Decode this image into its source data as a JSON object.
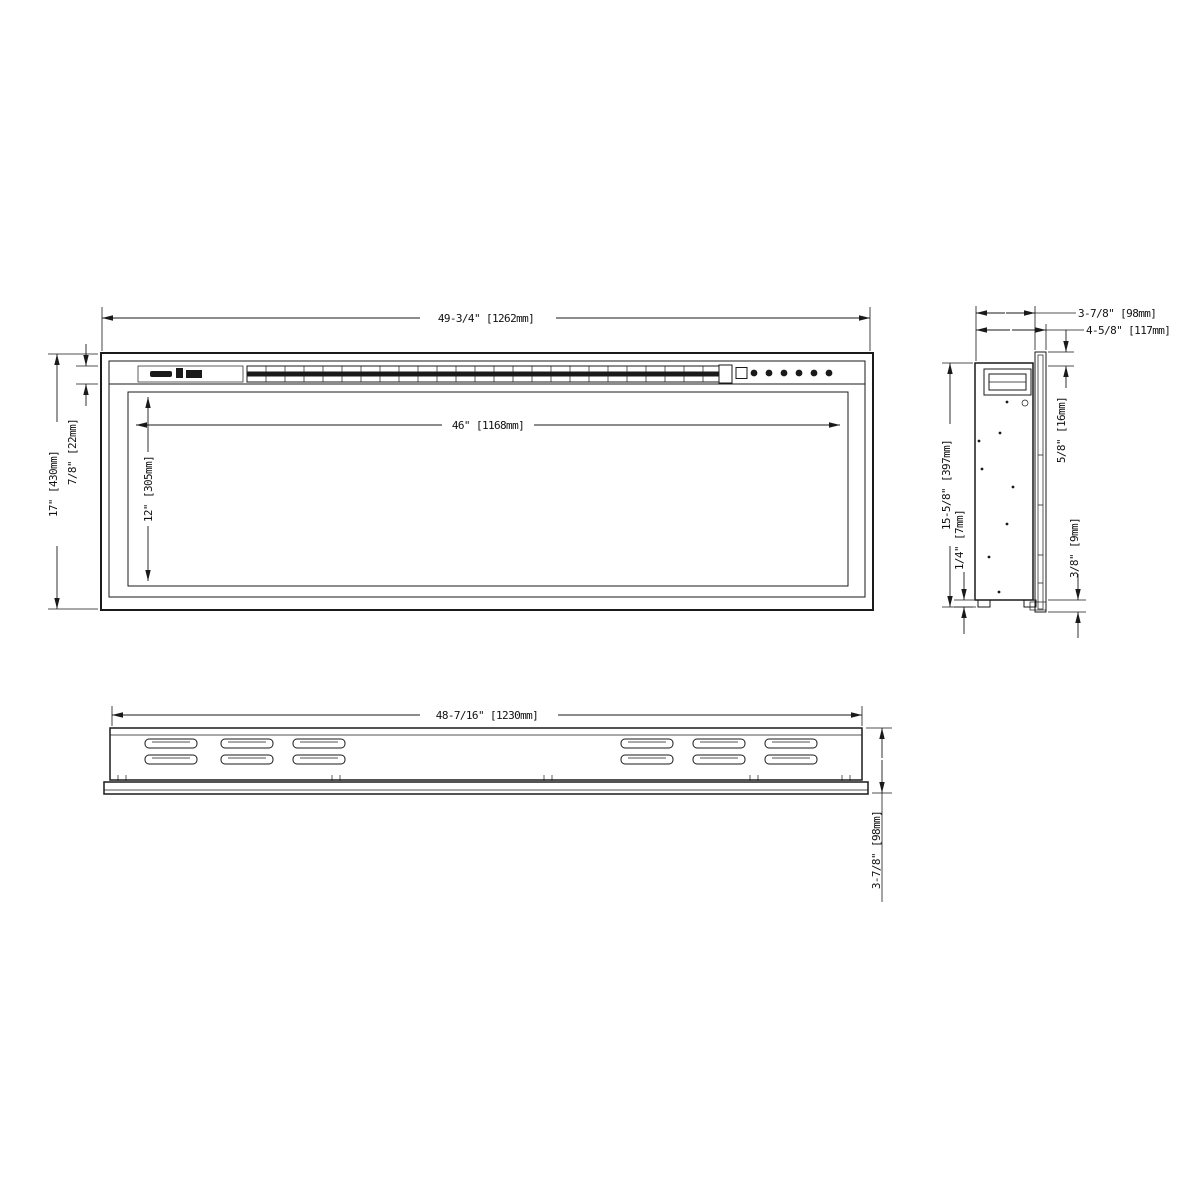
{
  "drawing": {
    "type": "electric-fireplace-dimension-drawing",
    "line_color": "#1a1a1a",
    "background_color": "#ffffff",
    "front_view": {
      "width_label": "49-3/4\" [1262mm]",
      "opening_width_label": "46\" [1168mm]",
      "opening_height_label": "12\" [305mm]",
      "height_label": "17\" [430mm]",
      "top_trim_label": "7/8\" [22mm]"
    },
    "side_view": {
      "depth_label": "3-7/8\" [98mm]",
      "total_depth_label": "4-5/8\" [117mm]",
      "flange_offset_label": "5/8\" [16mm]",
      "height_label": "15-5/8\" [397mm]",
      "foot_height_label": "1/4\" [7mm]",
      "flange_overhang_label": "3/8\" [9mm]"
    },
    "bottom_view": {
      "width_label": "48-7/16\" [1230mm]",
      "depth_label": "3-7/8\" [98mm]"
    }
  }
}
